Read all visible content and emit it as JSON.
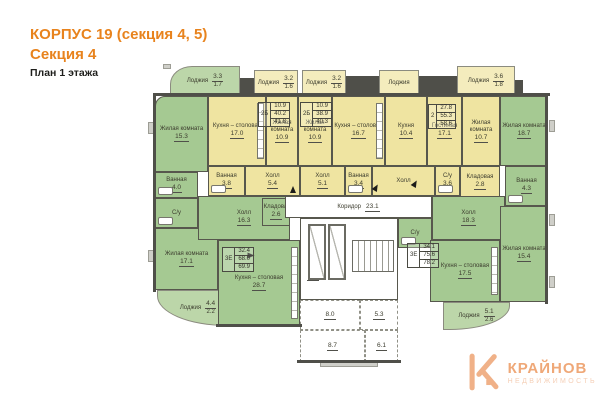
{
  "header": {
    "line1": "КОРПУС 19 (секция 4, 5)",
    "line2": "Секция 4",
    "line3": "План 1 этажа"
  },
  "logo": {
    "brand": "КРАЙНОВ",
    "sub": "НЕДВИЖИМОСТЬ",
    "icon": "house-k-icon",
    "color": "#f0b188"
  },
  "colors": {
    "apartment_yellow": "#efe4a1",
    "apartment_green": "#a5c992",
    "walls": "#4f4f49",
    "accent_orange": "#e8831d"
  },
  "plan": {
    "rooms": [
      {
        "id": "lodge-top-left",
        "type": "green-lodge",
        "cls": "row curve-tl",
        "x": 170,
        "y": 66,
        "w": 70,
        "h": 30,
        "label": "Лоджия",
        "area": "3.3",
        "area2": "1.7"
      },
      {
        "id": "lodge-a",
        "type": "yellow-lodge",
        "cls": "row",
        "x": 254,
        "y": 70,
        "w": 44,
        "h": 26,
        "label": "Лоджия",
        "area": "3.2",
        "area2": "1.6"
      },
      {
        "id": "lodge-b",
        "type": "yellow-lodge",
        "cls": "row",
        "x": 302,
        "y": 70,
        "w": 44,
        "h": 26,
        "label": "Лоджия",
        "area": "3.2",
        "area2": "1.6"
      },
      {
        "id": "lodge-c",
        "type": "yellow-lodge",
        "cls": "row",
        "x": 379,
        "y": 70,
        "w": 40,
        "h": 26,
        "label": "Лоджия"
      },
      {
        "id": "lodge-d",
        "type": "yellow-lodge",
        "cls": "row",
        "x": 457,
        "y": 66,
        "w": 58,
        "h": 30,
        "label": "Лоджия",
        "area": "3.6",
        "area2": "1.8"
      },
      {
        "id": "room-living-top-left",
        "type": "green",
        "cls": "curve-tl-sm",
        "x": 155,
        "y": 96,
        "w": 53,
        "h": 76,
        "label": "Жилая комната",
        "area": "15.3"
      },
      {
        "id": "room-bath-left",
        "type": "green",
        "x": 155,
        "y": 172,
        "w": 43,
        "h": 26,
        "label": "Ванная",
        "area": "4.0",
        "fixture": "bath"
      },
      {
        "id": "room-wc-left",
        "type": "green",
        "x": 155,
        "y": 198,
        "w": 43,
        "h": 30,
        "label": "С/у",
        "fixture": "bath"
      },
      {
        "id": "room-living-bottom-left",
        "type": "green",
        "x": 155,
        "y": 228,
        "w": 63,
        "h": 62,
        "label": "Жилая комната",
        "area": "17.1"
      },
      {
        "id": "lodge-bottom-left",
        "type": "green-lodge",
        "cls": "row curve-bl",
        "x": 157,
        "y": 290,
        "w": 82,
        "h": 36,
        "label": "Лоджия",
        "area": "4.4",
        "area2": "2.2"
      },
      {
        "id": "room-hall-left",
        "type": "green",
        "x": 198,
        "y": 196,
        "w": 92,
        "h": 44,
        "label": "Холл",
        "area": "16.3"
      },
      {
        "id": "room-pantry-left",
        "type": "green",
        "x": 262,
        "y": 198,
        "w": 28,
        "h": 28,
        "label": "Кладовая",
        "area": "2.6"
      },
      {
        "id": "room-kitchen-left",
        "type": "green",
        "x": 218,
        "y": 240,
        "w": 82,
        "h": 86,
        "label": "Кухня – столовая",
        "area": "28.7",
        "fixture": "right"
      },
      {
        "id": "room-kitchen-a",
        "type": "yellow",
        "x": 208,
        "y": 96,
        "w": 58,
        "h": 70,
        "label": "Кухня – столовая",
        "area": "17.0",
        "fixture": "right"
      },
      {
        "id": "room-bedroom-a",
        "type": "yellow",
        "x": 266,
        "y": 96,
        "w": 32,
        "h": 70,
        "label": "Жилая комната",
        "area": "10.9"
      },
      {
        "id": "room-bath-a",
        "type": "yellow",
        "x": 208,
        "y": 166,
        "w": 37,
        "h": 30,
        "label": "Ванная",
        "area": "3.8",
        "fixture": "bath"
      },
      {
        "id": "room-hall-a",
        "type": "yellow",
        "x": 245,
        "y": 166,
        "w": 55,
        "h": 30,
        "label": "Холл",
        "area": "5.4"
      },
      {
        "id": "room-bedroom-b",
        "type": "yellow",
        "x": 298,
        "y": 96,
        "w": 34,
        "h": 70,
        "label": "Жилая комната",
        "area": "10.9"
      },
      {
        "id": "room-kitchen-b",
        "type": "yellow",
        "x": 332,
        "y": 96,
        "w": 53,
        "h": 70,
        "label": "Кухня – столовая",
        "area": "16.7",
        "fixture": "right"
      },
      {
        "id": "room-hall-b",
        "type": "yellow",
        "x": 300,
        "y": 166,
        "w": 45,
        "h": 30,
        "label": "Холл",
        "area": "5.1"
      },
      {
        "id": "room-bath-b",
        "type": "yellow",
        "x": 345,
        "y": 166,
        "w": 27,
        "h": 30,
        "label": "Ванная",
        "area": "3.4",
        "fixture": "bath"
      },
      {
        "id": "room-kitchen-c",
        "type": "yellow",
        "x": 385,
        "y": 96,
        "w": 42,
        "h": 70,
        "label": "Кухня",
        "area": "10.4"
      },
      {
        "id": "room-living-c",
        "type": "yellow",
        "x": 427,
        "y": 96,
        "w": 35,
        "h": 70,
        "label": "Гостиная",
        "area": "17.1"
      },
      {
        "id": "room-bedroom-c",
        "type": "yellow",
        "x": 462,
        "y": 96,
        "w": 38,
        "h": 70,
        "label": "Жилая комната",
        "area": "10.7"
      },
      {
        "id": "room-hall-c",
        "type": "yellow",
        "x": 372,
        "y": 166,
        "w": 63,
        "h": 30,
        "label": "Холл"
      },
      {
        "id": "room-wc-c",
        "type": "yellow",
        "x": 435,
        "y": 166,
        "w": 25,
        "h": 30,
        "label": "С/у",
        "area": "3.6",
        "fixture": "bath"
      },
      {
        "id": "room-pantry-c",
        "type": "yellow",
        "x": 460,
        "y": 166,
        "w": 40,
        "h": 32,
        "label": "Кладовая",
        "area": "2.8"
      },
      {
        "id": "room-living-top-right",
        "type": "green",
        "x": 500,
        "y": 96,
        "w": 48,
        "h": 70,
        "label": "Жилая комната",
        "area": "18.7"
      },
      {
        "id": "room-bath-top-right",
        "type": "green",
        "x": 505,
        "y": 166,
        "w": 43,
        "h": 40,
        "label": "Ванная",
        "area": "4.3",
        "fixture": "bath"
      },
      {
        "id": "room-hall-right",
        "type": "green",
        "x": 432,
        "y": 196,
        "w": 73,
        "h": 44,
        "label": "Холл",
        "area": "18.3"
      },
      {
        "id": "room-wc-right",
        "type": "green",
        "x": 398,
        "y": 218,
        "w": 34,
        "h": 30,
        "label": "С/у",
        "fixture": "bath"
      },
      {
        "id": "room-kitchen-right",
        "type": "green",
        "x": 430,
        "y": 240,
        "w": 70,
        "h": 62,
        "label": "Кухня – столовая",
        "area": "17.5",
        "fixture": "right"
      },
      {
        "id": "room-living-bottom-right",
        "type": "green",
        "x": 500,
        "y": 206,
        "w": 48,
        "h": 96,
        "label": "Жилая комната",
        "area": "15.4"
      },
      {
        "id": "lodge-right",
        "type": "green-lodge",
        "cls": "row curve-br",
        "x": 443,
        "y": 302,
        "w": 67,
        "h": 28,
        "label": "Лоджия",
        "area": "5.1",
        "area2": "2.6"
      },
      {
        "id": "corridor",
        "type": "white",
        "cls": "row",
        "x": 285,
        "y": 196,
        "w": 147,
        "h": 22,
        "label": "Коридор",
        "area": "23.1"
      },
      {
        "id": "elevator-lobby",
        "type": "white",
        "x": 300,
        "y": 218,
        "w": 98,
        "h": 82
      },
      {
        "id": "lobby-area-label",
        "type": "none",
        "x": 300,
        "y": 268,
        "w": 26,
        "h": 16,
        "area": "8.1"
      },
      {
        "id": "vestibule-1",
        "type": "white",
        "cls": "dashed",
        "x": 300,
        "y": 300,
        "w": 60,
        "h": 30,
        "area": "8.0"
      },
      {
        "id": "vestibule-2",
        "type": "white",
        "cls": "dashed",
        "x": 360,
        "y": 300,
        "w": 38,
        "h": 30,
        "area": "5.3"
      },
      {
        "id": "vestibule-3",
        "type": "white",
        "cls": "dashed",
        "x": 300,
        "y": 330,
        "w": 65,
        "h": 32,
        "area": "8.7"
      },
      {
        "id": "vestibule-4",
        "type": "white",
        "cls": "dashed",
        "x": 365,
        "y": 330,
        "w": 33,
        "h": 32,
        "area": "6.1"
      }
    ],
    "spec_tables": [
      {
        "id": "spec-apt-a",
        "code": "2Б",
        "values": [
          "10.9",
          "40.2",
          "41.8"
        ],
        "x": 258,
        "y": 102
      },
      {
        "id": "spec-apt-b",
        "code": "2Б",
        "values": [
          "10.9",
          "38.9",
          "40.3"
        ],
        "x": 300,
        "y": 102
      },
      {
        "id": "spec-apt-c",
        "code": "2",
        "values": [
          "27.8",
          "55.3",
          "58.6"
        ],
        "x": 428,
        "y": 104
      },
      {
        "id": "spec-apt-left",
        "code": "3Е",
        "values": [
          "32.4",
          "68.0",
          "69.9"
        ],
        "x": 222,
        "y": 247
      },
      {
        "id": "spec-apt-right",
        "code": "3Е",
        "values": [
          "34.1",
          "75.6",
          "78.2"
        ],
        "x": 407,
        "y": 243
      }
    ],
    "walls": [
      {
        "x": 153,
        "y": 93,
        "w": 397,
        "h": 3
      },
      {
        "x": 153,
        "y": 93,
        "w": 3,
        "h": 199
      },
      {
        "x": 545,
        "y": 93,
        "w": 3,
        "h": 211
      },
      {
        "x": 216,
        "y": 324,
        "w": 86,
        "h": 3
      },
      {
        "x": 297,
        "y": 360,
        "w": 104,
        "h": 3
      },
      {
        "x": 240,
        "y": 78,
        "w": 14,
        "h": 17
      },
      {
        "x": 346,
        "y": 76,
        "w": 33,
        "h": 19
      },
      {
        "x": 419,
        "y": 76,
        "w": 38,
        "h": 19
      },
      {
        "x": 515,
        "y": 80,
        "w": 8,
        "h": 15
      }
    ],
    "stubs": [
      {
        "x": 148,
        "y": 122,
        "w": 6,
        "h": 12
      },
      {
        "x": 148,
        "y": 250,
        "w": 6,
        "h": 12
      },
      {
        "x": 549,
        "y": 120,
        "w": 6,
        "h": 12
      },
      {
        "x": 549,
        "y": 214,
        "w": 6,
        "h": 12
      },
      {
        "x": 549,
        "y": 276,
        "w": 6,
        "h": 12
      },
      {
        "x": 163,
        "y": 64,
        "w": 8,
        "h": 5
      },
      {
        "x": 320,
        "y": 362,
        "w": 58,
        "h": 5
      }
    ],
    "features": [
      {
        "kind": "elevator",
        "x": 308,
        "y": 224,
        "w": 18,
        "h": 56
      },
      {
        "kind": "elevator",
        "x": 328,
        "y": 224,
        "w": 18,
        "h": 56
      },
      {
        "kind": "stairs",
        "x": 352,
        "y": 240,
        "w": 42,
        "h": 32
      },
      {
        "kind": "arrow",
        "x": 248,
        "y": 252,
        "rot": 90
      },
      {
        "kind": "arrow",
        "x": 290,
        "y": 186,
        "rot": 0
      },
      {
        "kind": "arrow",
        "x": 373,
        "y": 184,
        "rot": 30
      },
      {
        "kind": "arrow",
        "x": 412,
        "y": 180,
        "rot": 30
      }
    ]
  }
}
